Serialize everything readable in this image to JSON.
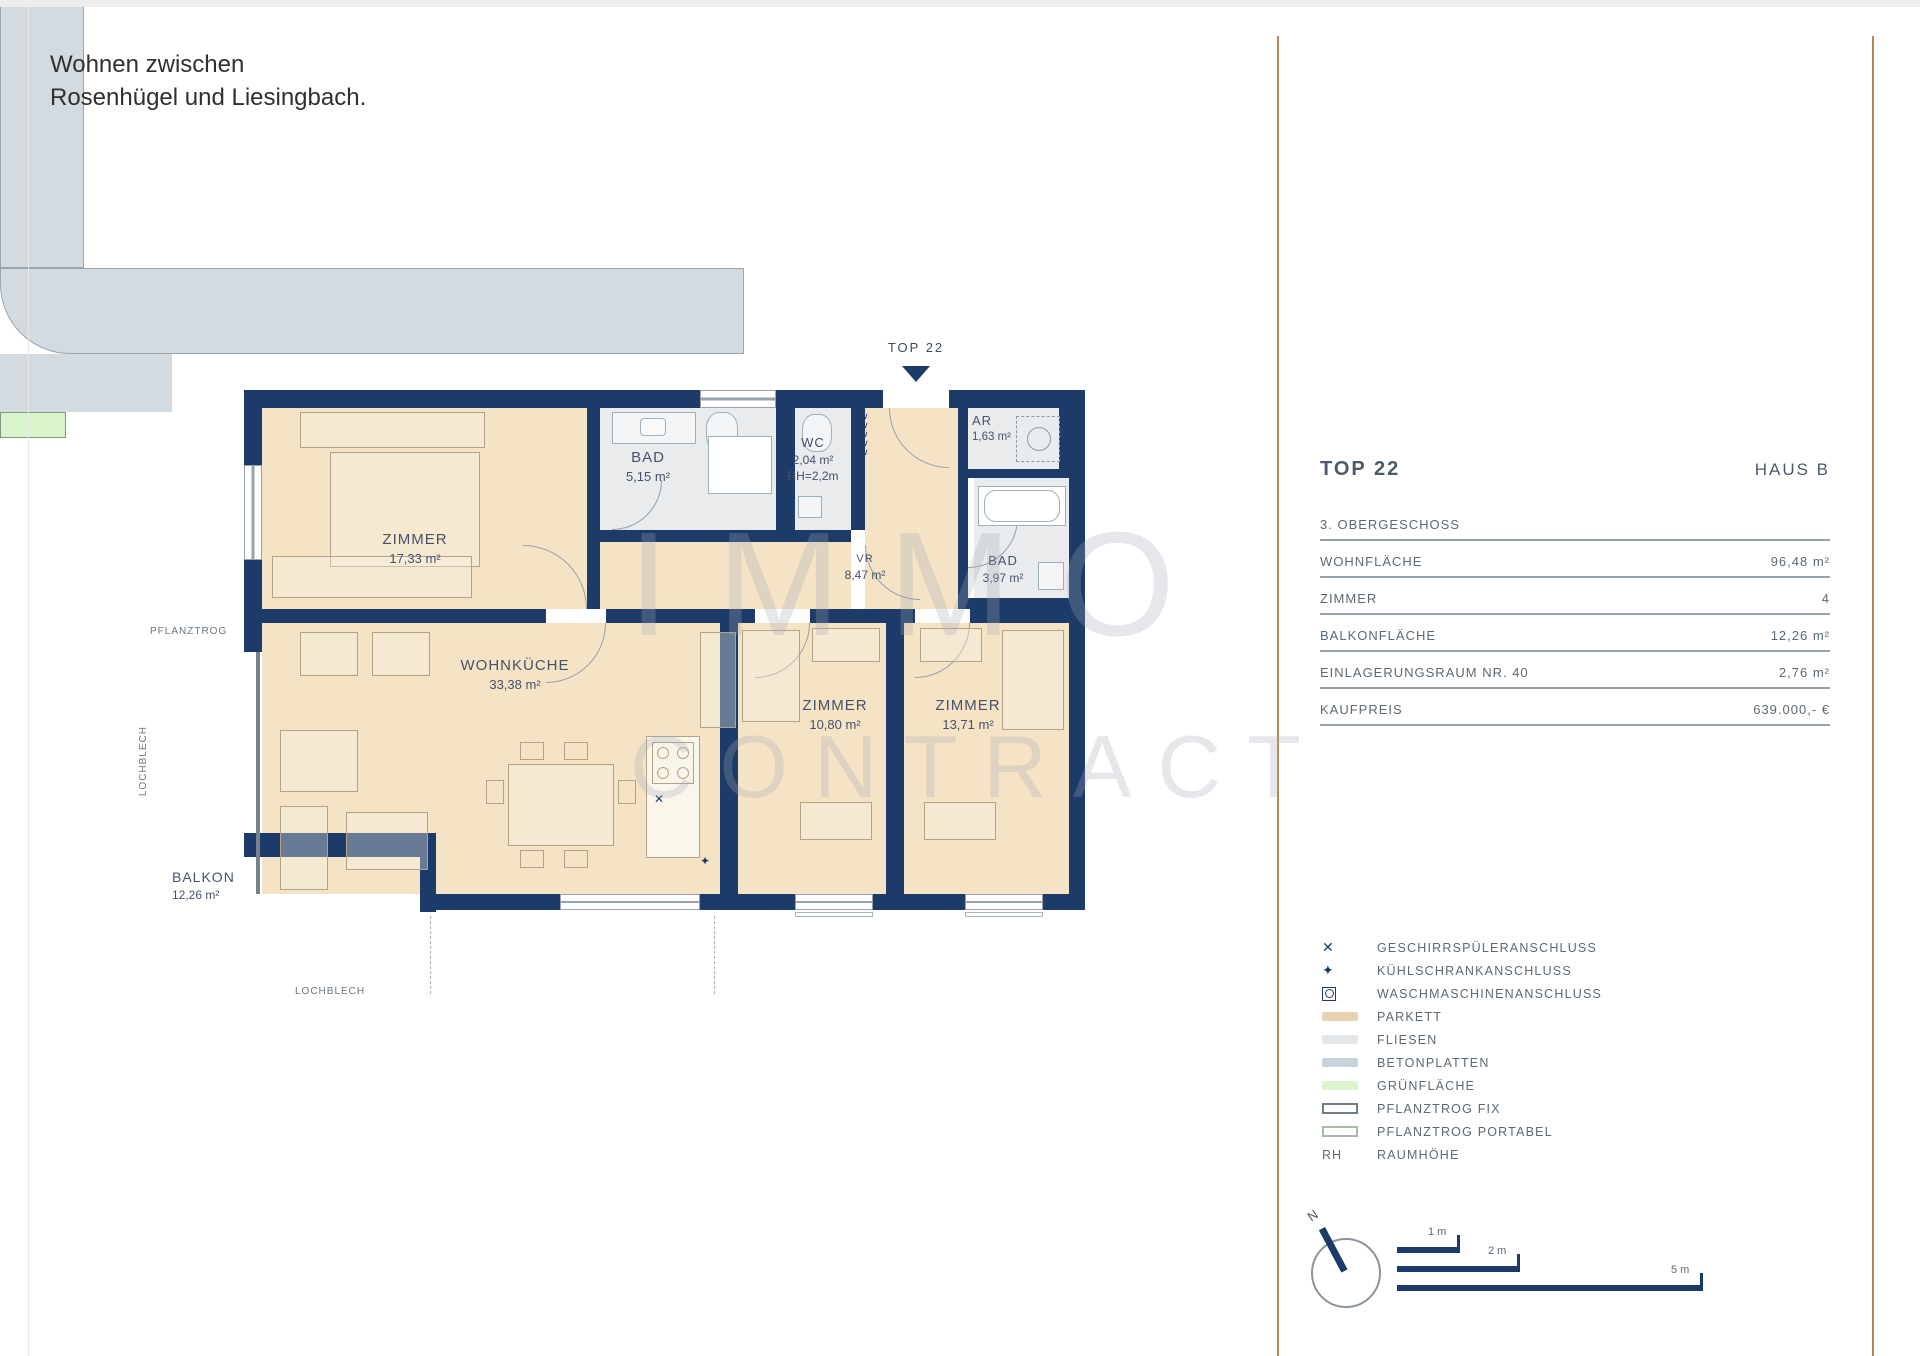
{
  "page": {
    "header_line1": "Wohnen zwischen",
    "header_line2": "Rosenhügel und Liesingbach."
  },
  "plan": {
    "entrance_label": "TOP 22",
    "rooms": [
      {
        "id": "zimmer-1",
        "name": "ZIMMER",
        "area": "17,33 m²"
      },
      {
        "id": "bad-1",
        "name": "BAD",
        "area": "5,15 m²"
      },
      {
        "id": "wc",
        "name": "WC",
        "area": "2,04 m²",
        "note": "RH=2,2m"
      },
      {
        "id": "ar",
        "name": "AR",
        "area": "1,63 m²"
      },
      {
        "id": "bad-2",
        "name": "BAD",
        "area": "3,97 m²"
      },
      {
        "id": "vorraum",
        "name": "VR",
        "area": "8,47 m²"
      },
      {
        "id": "wohnkueche",
        "name": "WOHNKÜCHE",
        "area": "33,38 m²"
      },
      {
        "id": "zimmer-2",
        "name": "ZIMMER",
        "area": "10,80 m²"
      },
      {
        "id": "zimmer-3",
        "name": "ZIMMER",
        "area": "13,71 m²"
      },
      {
        "id": "balkon",
        "name": "BALKON",
        "area": "12,26 m²"
      }
    ],
    "annotations": {
      "pflanztrog": "PFLANZTROG",
      "lochblech_left": "LOCHBLECH",
      "lochblech_bottom": "LOCHBLECH"
    },
    "watermark_line1": "IMMO",
    "watermark_line2": "CONTRACT"
  },
  "panel": {
    "title": "TOP 22",
    "subtitle_right": "HAUS B",
    "rows": [
      {
        "label": "3. OBERGESCHOSS",
        "value": ""
      },
      {
        "label": "WOHNFLÄCHE",
        "value": "96,48 m²"
      },
      {
        "label": "ZIMMER",
        "value": "4"
      },
      {
        "label": "BALKONFLÄCHE",
        "value": "12,26 m²"
      },
      {
        "label": "EINLAGERUNGSRAUM NR. 40",
        "value": "2,76 m²"
      },
      {
        "label": "KAUFPREIS",
        "value": "639.000,- €"
      }
    ],
    "legend": [
      {
        "type": "glyph",
        "glyph": "✕",
        "icon": "dishwasher-connection-icon",
        "label": "GESCHIRRSPÜLERANSCHLUSS"
      },
      {
        "type": "glyph",
        "glyph": "✦",
        "icon": "fridge-connection-icon",
        "label": "KÜHLSCHRANKANSCHLUSS"
      },
      {
        "type": "wm",
        "icon": "washing-machine-connection-icon",
        "label": "WASCHMASCHINENANSCHLUSS"
      },
      {
        "type": "swatch",
        "color": "#e7d1b0",
        "icon": "parkett-swatch",
        "label": "PARKETT"
      },
      {
        "type": "swatch",
        "color": "#e4e7e9",
        "icon": "fliesen-swatch",
        "label": "FLIESEN"
      },
      {
        "type": "swatch",
        "color": "#c9d4da",
        "icon": "betonplatten-swatch",
        "label": "BETONPLATTEN"
      },
      {
        "type": "swatch",
        "color": "#ddf2cf",
        "icon": "gruenflaeche-swatch",
        "label": "GRÜNFLÄCHE"
      },
      {
        "type": "outline",
        "color": "#6f7d88",
        "icon": "pflanztrog-fix-swatch",
        "label": "PFLANZTROG FIX"
      },
      {
        "type": "outline",
        "color": "#a8bba4",
        "icon": "pflanztrog-portabel-swatch",
        "label": "PFLANZTROG PORTABEL"
      },
      {
        "type": "text",
        "text": "RH",
        "icon": "rh-abbreviation",
        "label": "RAUMHÖHE"
      }
    ],
    "compass_label": "N",
    "scalebars": [
      {
        "label": "1 m"
      },
      {
        "label": "2 m"
      },
      {
        "label": "5 m"
      }
    ]
  }
}
